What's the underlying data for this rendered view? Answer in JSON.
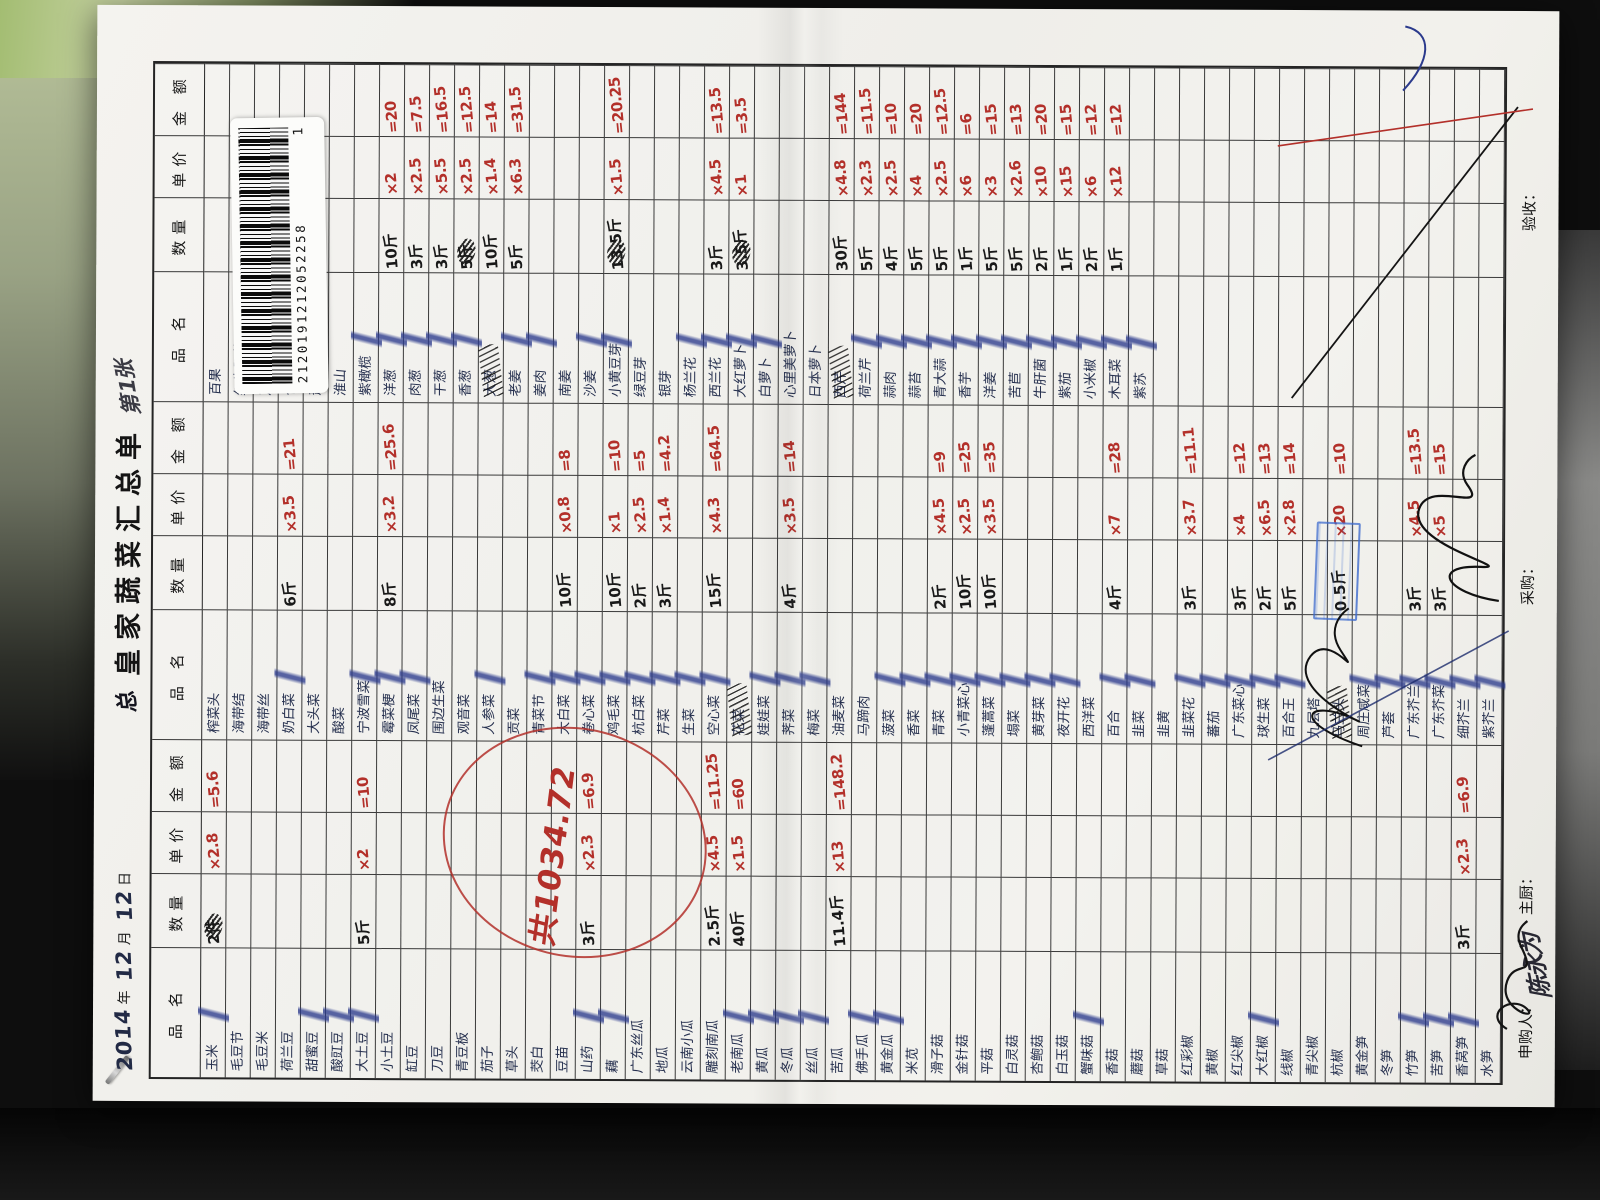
{
  "colors": {
    "ink_blue": "#26304f",
    "ink_red": "#b3302a",
    "check_blue": "#2b3a8c",
    "paper": "#f2f1ed"
  },
  "title": {
    "year": "2014",
    "year_label": "年",
    "month": "12",
    "month_label": "月",
    "day": "12",
    "day_label": "日",
    "pre": "总",
    "main": "皇家蔬菜汇总单",
    "flourish": "第1张"
  },
  "barcode": {
    "number": "2120191212052258",
    "page": "1"
  },
  "headers": {
    "name": "品 名",
    "qty": "数量",
    "price": "单价",
    "amount": "金 额"
  },
  "total_note": "共1034.72",
  "footer": {
    "applicant_label": "申购人：",
    "applicant_sig": "陈永为",
    "chef_label": "主厨：",
    "buyer_label": "采购：",
    "receiver_label": "验收："
  },
  "groups": [
    {
      "rows": [
        {
          "n": "玉米",
          "q": "2件",
          "p": "×2.8",
          "a": "=5.6",
          "c": 1,
          "t": 1
        },
        {
          "n": "毛豆节"
        },
        {
          "n": "毛豆米"
        },
        {
          "n": "荷兰豆"
        },
        {
          "n": "甜蜜豆",
          "c": 1
        },
        {
          "n": "酸豇豆",
          "c": 1
        },
        {
          "n": "大土豆",
          "q": "5斤",
          "p": "×2",
          "a": "=10",
          "c": 1
        },
        {
          "n": "小土豆"
        },
        {
          "n": "缸豆"
        },
        {
          "n": "刀豆"
        },
        {
          "n": "青豆板"
        },
        {
          "n": "茄子"
        },
        {
          "n": "草头"
        },
        {
          "n": "茭白"
        },
        {
          "n": "豆苗"
        },
        {
          "n": "山药",
          "q": "3斤",
          "p": "×2.3",
          "a": "=6.9",
          "c": 1
        },
        {
          "n": "藕",
          "c": 1
        },
        {
          "n": "广东丝瓜"
        },
        {
          "n": "地瓜"
        },
        {
          "n": "云南小瓜"
        },
        {
          "n": "雕刻南瓜",
          "q": "2.5斤",
          "p": "×4.5",
          "a": "=11.25"
        },
        {
          "n": "老南瓜",
          "q": "40斤",
          "p": "×1.5",
          "a": "=60",
          "c": 1
        },
        {
          "n": "黄瓜",
          "c": 1
        },
        {
          "n": "冬瓜",
          "c": 1
        },
        {
          "n": "丝瓜",
          "c": 1
        },
        {
          "n": "苦瓜",
          "q": "11.4斤",
          "p": "×13",
          "a": "=148.2"
        },
        {
          "n": "佛手瓜",
          "c": 1
        },
        {
          "n": "黄金瓜",
          "c": 1
        },
        {
          "n": "米苋"
        },
        {
          "n": "滑子菇"
        },
        {
          "n": "金针菇"
        },
        {
          "n": "平菇"
        },
        {
          "n": "白灵菇"
        },
        {
          "n": "杏鲍菇"
        },
        {
          "n": "白玉菇"
        },
        {
          "n": "蟹味菇",
          "c": 1
        },
        {
          "n": "香菇"
        },
        {
          "n": "蘑菇"
        },
        {
          "n": "草菇"
        },
        {
          "n": "红彩椒"
        },
        {
          "n": "黄椒"
        },
        {
          "n": "红尖椒"
        },
        {
          "n": "大红椒",
          "c": 1
        },
        {
          "n": "线椒"
        },
        {
          "n": "青尖椒"
        },
        {
          "n": "杭椒"
        },
        {
          "n": "黄金笋"
        },
        {
          "n": "冬笋"
        },
        {
          "n": "竹笋",
          "c": 1
        },
        {
          "n": "苦笋",
          "c": 1
        },
        {
          "n": "香莴笋",
          "q": "3斤",
          "p": "×2.3",
          "a": "=6.9",
          "c": 1
        },
        {
          "n": "水笋"
        }
      ]
    },
    {
      "rows": [
        {
          "n": "榨菜头"
        },
        {
          "n": "海带结"
        },
        {
          "n": "海带丝"
        },
        {
          "n": "奶白菜",
          "q": "6斤",
          "p": "×3.5",
          "a": "=21",
          "c": 1
        },
        {
          "n": "大头菜"
        },
        {
          "n": "酸菜"
        },
        {
          "n": "宁波雪菜",
          "c": 1
        },
        {
          "n": "霉菜梗",
          "q": "8斤",
          "p": "×3.2",
          "a": "=25.6",
          "c": 1
        },
        {
          "n": "凤尾菜",
          "c": 1
        },
        {
          "n": "围边生菜"
        },
        {
          "n": "观音菜"
        },
        {
          "n": "人参菜",
          "c": 1
        },
        {
          "n": "贡菜"
        },
        {
          "n": "青菜节",
          "c": 1
        },
        {
          "n": "大白菜",
          "q": "10斤",
          "p": "×0.8",
          "a": "=8",
          "c": 1
        },
        {
          "n": "卷心菜",
          "c": 1
        },
        {
          "n": "鸡毛菜",
          "q": "10斤",
          "p": "×1",
          "a": "=10",
          "c": 1
        },
        {
          "n": "杭白菜",
          "q": "2斤",
          "p": "×2.5",
          "a": "=5",
          "c": 1
        },
        {
          "n": "芹菜",
          "q": "3斤",
          "p": "×1.4",
          "a": "=4.2",
          "c": 1
        },
        {
          "n": "生菜",
          "c": 1
        },
        {
          "n": "空心菜",
          "q": "15斤",
          "p": "×4.3",
          "a": "=64.5",
          "c": 1
        },
        {
          "n": "花菜",
          "s": 1
        },
        {
          "n": "娃娃菜",
          "c": 1
        },
        {
          "n": "荠菜",
          "q": "4斤",
          "p": "×3.5",
          "a": "=14",
          "c": 1
        },
        {
          "n": "梅菜",
          "c": 1
        },
        {
          "n": "油麦菜"
        },
        {
          "n": "马蹄肉"
        },
        {
          "n": "菠菜",
          "c": 1
        },
        {
          "n": "香菜",
          "c": 1
        },
        {
          "n": "青菜",
          "q": "2斤",
          "p": "×4.5",
          "a": "=9",
          "c": 1
        },
        {
          "n": "小青菜心",
          "q": "10斤",
          "p": "×2.5",
          "a": "=25",
          "c": 1
        },
        {
          "n": "蓬蒿菜",
          "q": "10斤",
          "p": "×3.5",
          "a": "=35",
          "c": 1
        },
        {
          "n": "塌菜",
          "c": 1
        },
        {
          "n": "黄芽菜",
          "c": 1
        },
        {
          "n": "夜开花",
          "c": 1
        },
        {
          "n": "西洋菜"
        },
        {
          "n": "百合",
          "q": "4斤",
          "p": "×7",
          "a": "=28",
          "c": 1
        },
        {
          "n": "韭菜",
          "c": 1
        },
        {
          "n": "韭黄"
        },
        {
          "n": "韭菜花",
          "q": "3斤",
          "p": "×3.7",
          "a": "=11.1",
          "c": 1
        },
        {
          "n": "蕃茄",
          "c": 1
        },
        {
          "n": "广东菜心",
          "q": "3斤",
          "p": "×4",
          "a": "=12",
          "c": 1
        },
        {
          "n": "球生菜",
          "q": "2斤",
          "p": "×6.5",
          "a": "=13",
          "c": 1
        },
        {
          "n": "百合王",
          "q": "5斤",
          "p": "×2.8",
          "a": "=14",
          "c": 1
        },
        {
          "n": "九层塔"
        },
        {
          "n": "马兰头",
          "q": "0.5斤",
          "p": "×20",
          "a": "=10",
          "s": 1
        },
        {
          "n": "周庄咸菜",
          "c": 1
        },
        {
          "n": "芦荟",
          "c": 1
        },
        {
          "n": "广东芥兰",
          "q": "3斤",
          "p": "×4.5",
          "a": "=13.5",
          "c": 1
        },
        {
          "n": "广东芥菜",
          "q": "3斤",
          "p": "×5",
          "a": "=15",
          "c": 1
        },
        {
          "n": "细芥兰",
          "c": 1
        },
        {
          "n": "紫芥兰",
          "c": 1
        }
      ]
    },
    {
      "rows": [
        {
          "n": "百果"
        },
        {
          "n": "红牛肝菌"
        },
        {
          "n": "芦笋"
        },
        {
          "n": "包菜"
        },
        {
          "n": "萧山萝卜"
        },
        {
          "n": "淮山"
        },
        {
          "n": "紫橄榄",
          "c": 1
        },
        {
          "n": "洋葱",
          "q": "10斤",
          "p": "×2",
          "a": "=20",
          "c": 1
        },
        {
          "n": "肉葱",
          "q": "3斤",
          "p": "×2.5",
          "a": "=7.5",
          "c": 1
        },
        {
          "n": "干葱",
          "q": "3斤",
          "p": "×5.5",
          "a": "=16.5",
          "c": 1
        },
        {
          "n": "香葱",
          "q": "5斤",
          "p": "×2.5",
          "a": "=12.5",
          "c": 1,
          "t": 1
        },
        {
          "n": "大葱",
          "q": "10斤",
          "p": "×1.4",
          "a": "=14",
          "s": 1
        },
        {
          "n": "老姜",
          "q": "5斤",
          "p": "×6.3",
          "a": "=31.5",
          "c": 1
        },
        {
          "n": "姜肉",
          "c": 1
        },
        {
          "n": "南姜"
        },
        {
          "n": "沙姜",
          "c": 1
        },
        {
          "n": "小黄豆芽",
          "q": "13.5斤",
          "p": "×1.5",
          "a": "=20.25",
          "c": 1,
          "t": 1
        },
        {
          "n": "绿豆芽"
        },
        {
          "n": "银芽"
        },
        {
          "n": "杨兰花",
          "c": 1
        },
        {
          "n": "西兰花",
          "q": "3斤",
          "p": "×4.5",
          "a": "=13.5",
          "c": 1
        },
        {
          "n": "大红萝卜",
          "q": "3.5斤",
          "p": "×1",
          "a": "=3.5",
          "c": 1,
          "t": 1
        },
        {
          "n": "白萝卜",
          "c": 1
        },
        {
          "n": "心里美萝卜"
        },
        {
          "n": "日本萝卜"
        },
        {
          "n": "西芹",
          "q": "30斤",
          "p": "×4.8",
          "a": "=144",
          "s": 1
        },
        {
          "n": "荷兰芹",
          "q": "5斤",
          "p": "×2.3",
          "a": "=11.5",
          "c": 1
        },
        {
          "n": "蒜肉",
          "q": "4斤",
          "p": "×2.5",
          "a": "=10",
          "c": 1
        },
        {
          "n": "蒜苔",
          "q": "5斤",
          "p": "×4",
          "a": "=20",
          "c": 1
        },
        {
          "n": "青大蒜",
          "q": "5斤",
          "p": "×2.5",
          "a": "=12.5",
          "c": 1
        },
        {
          "n": "香芋",
          "q": "1斤",
          "p": "×6",
          "a": "=6",
          "c": 1
        },
        {
          "n": "洋姜",
          "q": "5斤",
          "p": "×3",
          "a": "=15",
          "c": 1
        },
        {
          "n": "苦苣",
          "q": "5斤",
          "p": "×2.6",
          "a": "=13",
          "c": 1
        },
        {
          "n": "牛肝菌",
          "q": "2斤",
          "p": "×10",
          "a": "=20",
          "c": 1
        },
        {
          "n": "紫茄",
          "q": "1斤",
          "p": "×15",
          "a": "=15",
          "c": 1
        },
        {
          "n": "小米椒",
          "q": "2斤",
          "p": "×6",
          "a": "=12",
          "c": 1
        },
        {
          "n": "木耳菜",
          "q": "1斤",
          "p": "×12",
          "a": "=12",
          "c": 1
        },
        {
          "n": "紫苏",
          "c": 1
        },
        {
          "n": ""
        },
        {
          "n": ""
        },
        {
          "n": ""
        },
        {
          "n": ""
        },
        {
          "n": ""
        },
        {
          "n": ""
        },
        {
          "n": ""
        },
        {
          "n": ""
        },
        {
          "n": ""
        },
        {
          "n": ""
        },
        {
          "n": ""
        },
        {
          "n": ""
        },
        {
          "n": ""
        },
        {
          "n": ""
        }
      ]
    }
  ]
}
